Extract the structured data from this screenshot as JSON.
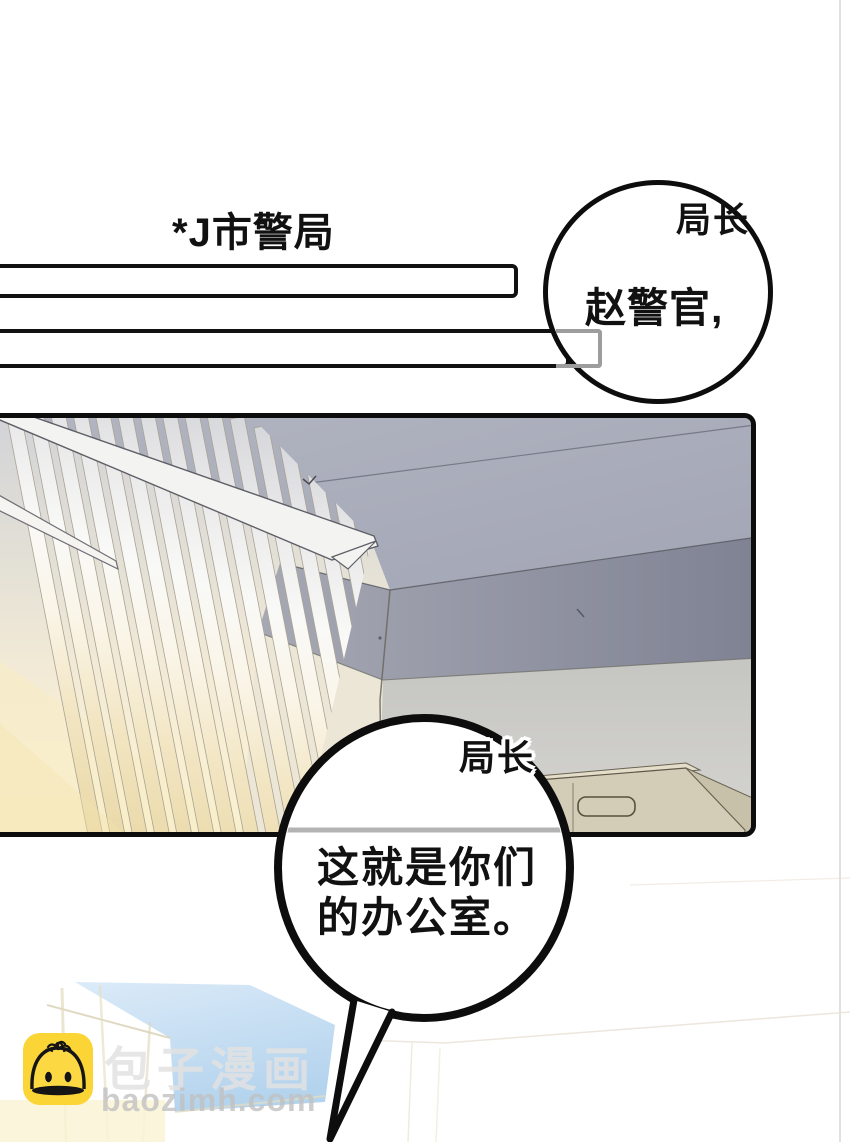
{
  "caption": {
    "text": "*J市警局"
  },
  "speech": [
    {
      "speaker_label": "局长",
      "text": "赵警官,"
    },
    {
      "speaker_label": "局长",
      "lines": [
        "这就是你们",
        "的办公室。"
      ]
    }
  ],
  "watermark": {
    "brand_cn": "包子漫画",
    "brand_domain": "baozimh.com",
    "icon": "baozi-bun-icon",
    "icon_color": "#fbd535"
  },
  "colors": {
    "page_background": "#ffffff",
    "panel_border": "#0d0d0d",
    "bubble_fill": "#ffffff",
    "bubble_stroke": "#0d0d0d",
    "caption_bar_border": "#111111",
    "gray_box_border": "#9d9d9d",
    "ceiling": "#a9acb9",
    "ceiling_band": "#8a8d9c",
    "wall_right": "#c9c9c5",
    "wall_left_cream": "#ece7d6",
    "cabinet_beige": "#d3cdb7",
    "sunlight": "#f6e8bc",
    "sky_blue": "#bcd7ef"
  },
  "scene": {
    "panel_description": "office-interior-ceiling-blinds-cabinet"
  }
}
